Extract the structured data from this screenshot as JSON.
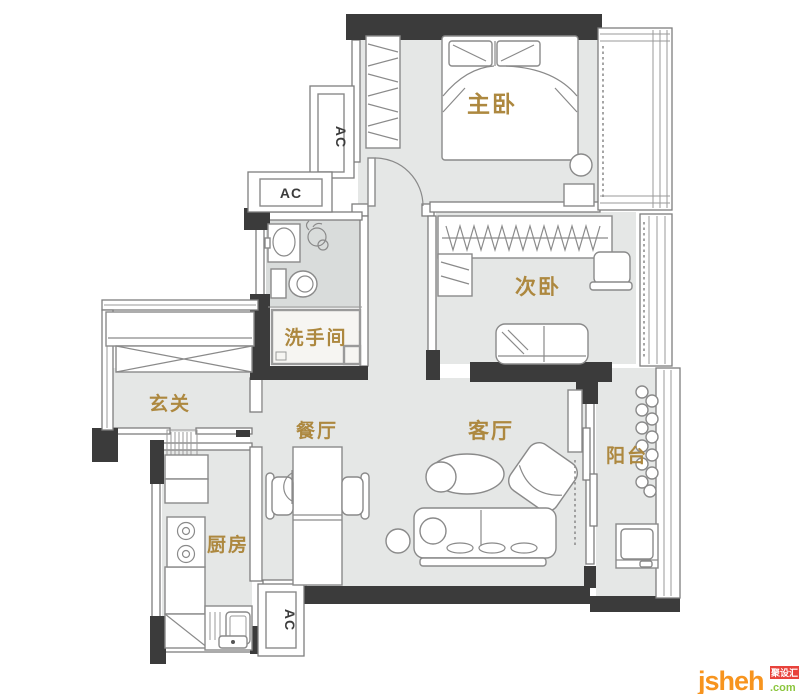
{
  "canvas": {
    "width": 800,
    "height": 694,
    "kind": "apartment floor plan"
  },
  "plan": {
    "rooms": [
      {
        "id": "master-bedroom",
        "label": "主卧"
      },
      {
        "id": "second-bedroom",
        "label": "次卧"
      },
      {
        "id": "bathroom",
        "label": "洗手间"
      },
      {
        "id": "entry",
        "label": "玄关"
      },
      {
        "id": "dining",
        "label": "餐厅"
      },
      {
        "id": "living",
        "label": "客厅"
      },
      {
        "id": "balcony",
        "label": "阳台"
      },
      {
        "id": "kitchen",
        "label": "厨房"
      }
    ],
    "ac_labels": [
      "AC",
      "AC",
      "AC"
    ]
  },
  "watermark": {
    "brand": "jsheh",
    "tld": ".com",
    "badge": "聚设汇"
  },
  "colors": {
    "wall": "#3b3b3b",
    "floor": "#e5e7e6",
    "wet_floor": "#d9dcdb",
    "line": "#8a8a8a",
    "label_gold": "#ad883f",
    "logo_orange": "#f7941e",
    "logo_green": "#8cc63e",
    "logo_red": "#e8423b"
  }
}
